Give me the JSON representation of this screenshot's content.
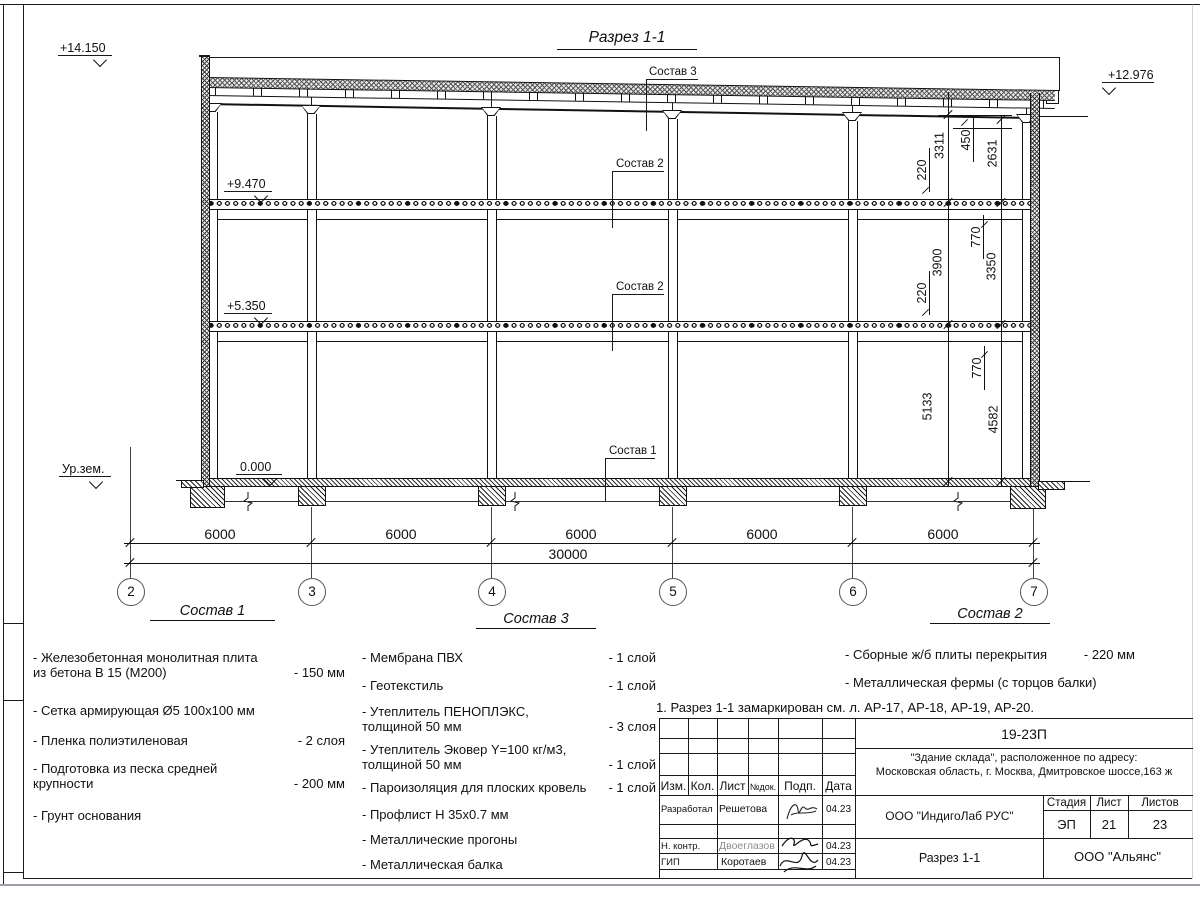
{
  "section": {
    "title": "Разрез 1-1",
    "elevations": {
      "parapet": "+14.150",
      "roof_right": "+12.976",
      "floor2": "+9.470",
      "floor1": "+5.350",
      "zero": "0.000",
      "ground": "Ур.зем."
    },
    "callouts": {
      "roof": "Состав 3",
      "slab_upper": "Состав 2",
      "slab_lower": "Состав 2",
      "floor": "Состав 1"
    },
    "vdims": [
      "220",
      "3311",
      "450",
      "2631",
      "220",
      "770",
      "3900",
      "3350",
      "770",
      "5133",
      "4582"
    ],
    "bays": [
      "6000",
      "6000",
      "6000",
      "6000",
      "6000"
    ],
    "total": "30000",
    "axes": [
      "2",
      "3",
      "4",
      "5",
      "6",
      "7"
    ]
  },
  "legends": [
    {
      "title": "Состав 1",
      "items": [
        {
          "text": "- Железобетонная  монолитная плита\nиз бетона В 15 (М200)",
          "value": "- 150 мм"
        },
        {
          "text": "- Сетка армирующая Ø5 100х100 мм",
          "value": ""
        },
        {
          "text": "- Пленка полиэтиленовая",
          "value": "-  2 слоя"
        },
        {
          "text": "- Подготовка из песка средней\nкрупности",
          "value": "- 200 мм"
        },
        {
          "text": "- Грунт основания",
          "value": ""
        }
      ]
    },
    {
      "title": "Состав 3",
      "items": [
        {
          "text": "- Мембрана ПВХ",
          "value": "- 1 слой"
        },
        {
          "text": "- Геотекстиль",
          "value": "- 1 слой"
        },
        {
          "text": "- Утеплитель ПЕНОПЛЭКС,\nтолщиной 50 мм",
          "value": "- 3 слоя"
        },
        {
          "text": "- Утеплитель Эковер Y=100 кг/м3,\nтолщиной 50 мм",
          "value": "- 1 слой"
        },
        {
          "text": "- Пароизоляция для плоских кровель",
          "value": "- 1 слой"
        },
        {
          "text": "- Профлист Н 35х0.7 мм",
          "value": ""
        },
        {
          "text": "- Металлические прогоны",
          "value": ""
        },
        {
          "text": "- Металлическая балка",
          "value": ""
        }
      ]
    },
    {
      "title": "Состав 2",
      "items": [
        {
          "text": "- Сборные ж/б плиты перекрытия",
          "value": "- 220 мм"
        },
        {
          "text": "- Металлическая фермы (с торцов балки)",
          "value": ""
        }
      ]
    }
  ],
  "note": "1. Разрез 1-1 замаркирован см. л. АР-17, АР-18, АР-19, АР-20.",
  "stamp": {
    "doc_code": "19-23П",
    "object_line1": "\"Здание склада\", расположенное по адресу:",
    "object_line2": "Московская область, г. Москва, Дмитровское шоссе,163 ж",
    "designer_org": "ООО \"ИндигоЛаб РУС\"",
    "sheet_title": "Разрез 1-1",
    "builder_org": "ООО \"Альянс\"",
    "stage_label": "Стадия",
    "stage_value": "ЭП",
    "sheet_label": "Лист",
    "sheet_value": "21",
    "sheets_label": "Листов",
    "sheets_value": "23",
    "columns": [
      "Изм.",
      "Кол.",
      "Лист",
      "№док.",
      "Подп.",
      "Дата"
    ],
    "rows": [
      {
        "role": "Разработал",
        "name": "Решетова",
        "date": "04.23"
      },
      {
        "role": "Н. контр.",
        "name": "Двоеглазов",
        "date": "04.23"
      },
      {
        "role": "ГИП",
        "name": "Коротаев",
        "date": "04.23"
      }
    ]
  }
}
